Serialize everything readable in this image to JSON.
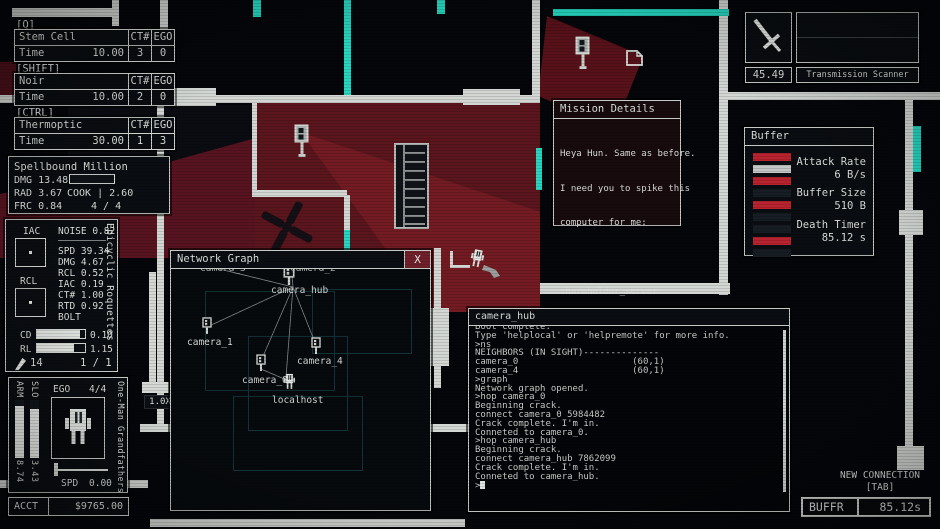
{
  "hud": {
    "abilities": [
      {
        "hotkey": "[Q]",
        "name": "Stem Cell Injection",
        "ct_header": "CT#",
        "ego_header": "EGO",
        "stat": "Time",
        "value": "10.00",
        "ct": "3",
        "ego": "0"
      },
      {
        "hotkey": "[SHIFT]",
        "name": "Noir",
        "ct_header": "CT#",
        "ego_header": "EGO",
        "stat": "Time",
        "value": "10.00",
        "ct": "2",
        "ego": "0"
      },
      {
        "hotkey": "[CTRL]",
        "name": "Thermoptic Camouflage",
        "ct_header": "CT#",
        "ego_header": "EGO",
        "stat": "Time",
        "value": "30.00",
        "ct": "1",
        "ego": "3"
      }
    ],
    "weapon": {
      "name": "Spellbound Million",
      "dmg": "DMG 13.48",
      "rad": "RAD 3.67",
      "cook": "COOK | 2.60",
      "frc": "FRC 0.84",
      "mag": "4 / 4"
    },
    "secondary": {
      "name": "Epicyclic Roquettes",
      "iac_label": "IAC",
      "rcl_label": "RCL",
      "noise": "NOISE 0.82",
      "stats": [
        "SPD 39.34",
        "DMG 4.67",
        "RCL 0.52",
        "IAC 0.19",
        "CT# 1.00",
        "RTD 0.92",
        "BOLT"
      ],
      "cd_label": "CD",
      "cd": "0.10",
      "rl_label": "RL",
      "rl": "1.15",
      "ammo": "14",
      "mag": "1 / 1"
    },
    "player": {
      "name": "One-Man Grandfathers",
      "arm_label": "ARM",
      "arm": "8.74",
      "slo_label": "SLO",
      "slo": "3.43",
      "ego_label": "EGO",
      "ego": "4/4",
      "spd_label": "SPD",
      "spd": "0.00"
    },
    "account": {
      "label": "ACCT",
      "value": "$9765.00"
    },
    "scanner": {
      "value": "45.49",
      "label": "Transmission Scanner"
    },
    "zoom_level": "1.0X"
  },
  "mission": {
    "title": "Mission Details",
    "lines": [
      "Heya Hun. Same as before.",
      "I need you to spike this",
      "computer for me:",
      "",
      "shareholder_server"
    ]
  },
  "buffer": {
    "title": "Buffer",
    "attack_rate_label": "Attack Rate",
    "attack_rate": "6 B/s",
    "buffer_size_label": "Buffer Size",
    "buffer_size": "510 B",
    "death_timer_label": "Death Timer",
    "death_timer": "85.12 s",
    "slots": [
      "background:#b7232e",
      "background:#c3c7c5",
      "background:#b7232e",
      "background:#161d23",
      "background:#b7232e",
      "background:#161d23",
      "background:#161d23",
      "background:#b7232e",
      "background:#161d23"
    ]
  },
  "network_graph": {
    "title": "Network Graph",
    "close": "X",
    "nodes": [
      "camera_3",
      "camera_2",
      "camera_hub",
      "camera_1",
      "camera_4",
      "camera_0",
      "localhost"
    ]
  },
  "terminal": {
    "title": "camera_hub",
    "partial_line": "Boot complete.",
    "lines": [
      "Type 'helplocal' or 'helpremote' for more info.",
      "",
      ">ns",
      "NEIGHBORS (IN SIGHT)--------------",
      "camera_0                     (60,1)",
      "camera_4                     (60,1)",
      ">graph",
      "Network graph opened.",
      ">hop camera_0",
      "Beginning crack.",
      "connect camera_0 5984482",
      "Crack complete. I'm in.",
      "Conneted to camera_0.",
      ">hop camera_hub",
      "Beginning crack.",
      "connect camera_hub 7862099",
      "Crack complete. I'm in.",
      "Conneted to camera_hub."
    ],
    "prompt": ">"
  },
  "connection": {
    "new_label": "NEW CONNECTION",
    "key_hint": "[TAB]",
    "buffer_label": "BUFFR",
    "time": "85.12s"
  }
}
